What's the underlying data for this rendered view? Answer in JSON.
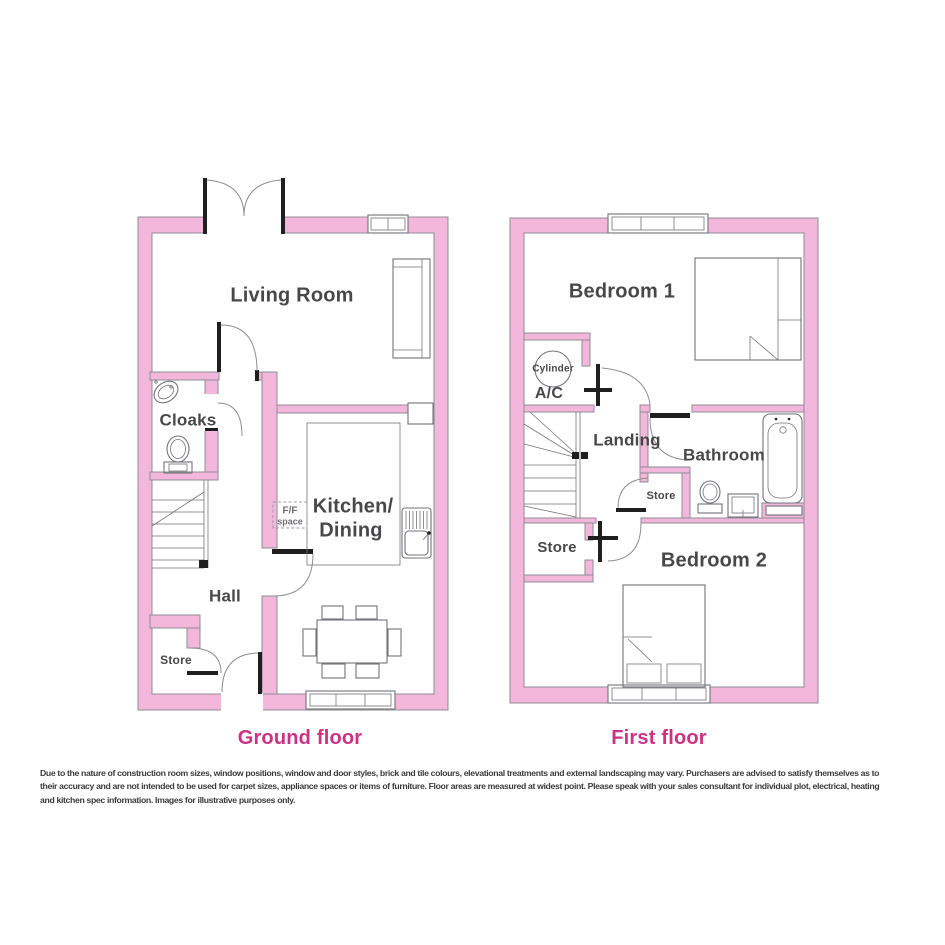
{
  "ground_floor": {
    "caption": "Ground floor",
    "rooms": {
      "living_room": "Living Room",
      "cloaks": "Cloaks",
      "hall": "Hall",
      "store": "Store",
      "kitchen_line1": "Kitchen/",
      "kitchen_line2": "Dining",
      "ff_line1": "F/F",
      "ff_line2": "space"
    }
  },
  "first_floor": {
    "caption": "First floor",
    "rooms": {
      "bedroom1": "Bedroom 1",
      "cylinder": "Cylinder",
      "ac": "A/C",
      "landing": "Landing",
      "bathroom": "Bathroom",
      "store_small": "Store",
      "store": "Store",
      "bedroom2": "Bedroom 2"
    }
  },
  "disclaimer": {
    "lines": [
      "Due to the nature of construction room sizes, window positions, window and door styles, brick and tile colours, elevational treatments and external landscaping may vary. Purchasers are advised to satisfy themselves as to",
      "their accuracy and are not intended to be used for carpet sizes, appliance spaces or items of furniture. Floor areas are measured at widest point. Please speak with your sales consultant for individual plot, electrical, heating",
      "and kitchen spec information. Images for illustrative purposes only."
    ]
  },
  "colors": {
    "wall_pink": "#F2B7DA",
    "wall_outline": "#8E8E96",
    "caption_pink": "#CE3184",
    "label_gray": "#48484A",
    "line_gray": "#74747A"
  }
}
